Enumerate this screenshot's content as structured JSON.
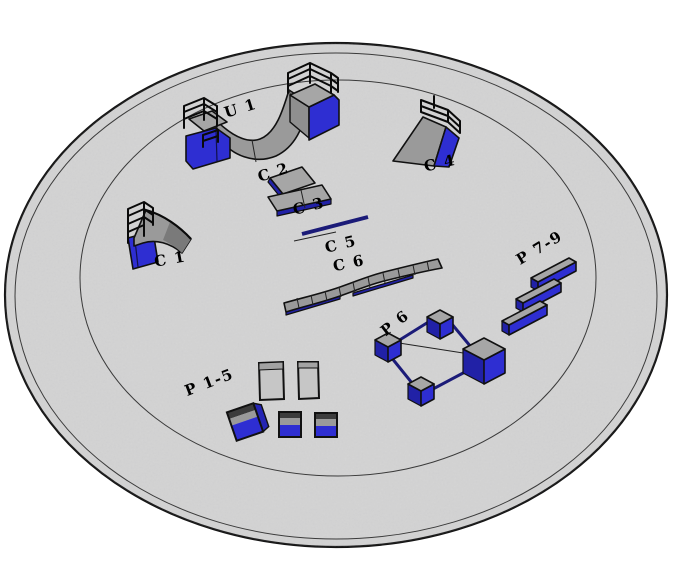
{
  "scene": {
    "background_color": "#ffffff",
    "ground_color": "#d5d5d5",
    "ramp_gray": "#a0a0a0",
    "accent_blue": "#2e2ed2",
    "accent_blue_dark": "#2121a6",
    "rail_navy": "#1b1b78",
    "outline_color": "#111111"
  },
  "labels": {
    "u1": "U 1",
    "c1": "C 1",
    "c2": "C 2",
    "c3": "C 3",
    "c4": "C 4",
    "c5": "C 5",
    "c6": "C 6",
    "p1_5": "P 1-5",
    "p6": "P 6",
    "p7_9": "P 7-9"
  }
}
